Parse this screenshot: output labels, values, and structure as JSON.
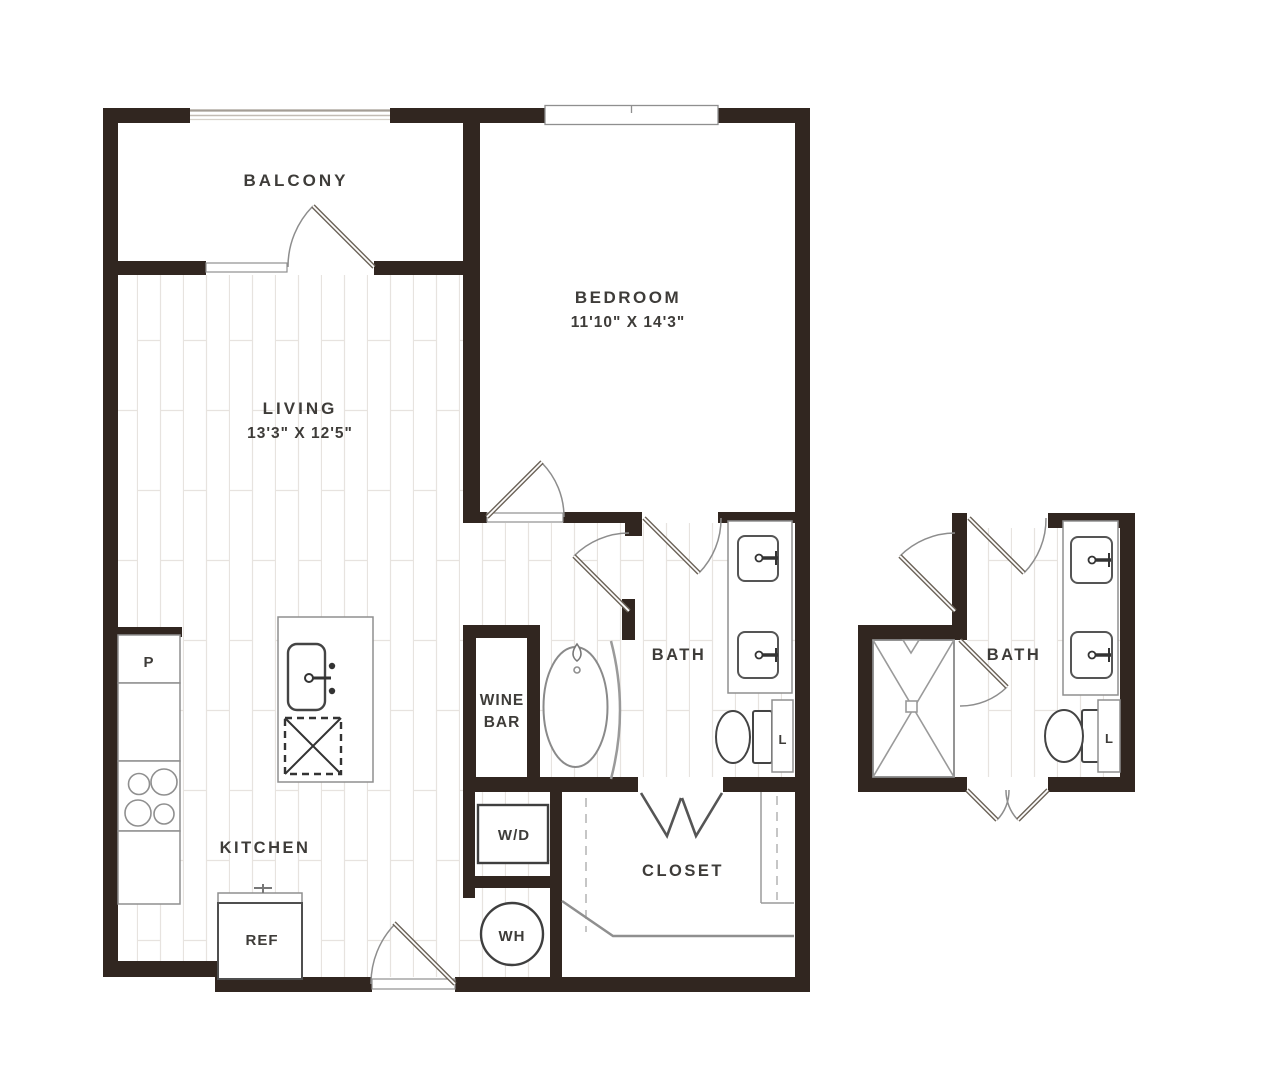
{
  "colors": {
    "wall": "#312620",
    "line": "#8f8f8f",
    "text": "#3e3c39",
    "plank": "#e7e3df",
    "fixdark": "#3f3f3f"
  },
  "rooms": {
    "balcony": {
      "label": "BALCONY"
    },
    "bedroom": {
      "label": "BEDROOM",
      "dims": "11'10\" X 14'3\""
    },
    "living": {
      "label": "LIVING",
      "dims": "13'3\" X 12'5\""
    },
    "kitchen": {
      "label": "KITCHEN"
    },
    "wine_bar": {
      "label_line1": "WINE",
      "label_line2": "BAR"
    },
    "bath": {
      "label": "BATH"
    },
    "closet": {
      "label": "CLOSET"
    }
  },
  "fixtures": {
    "washer_dryer": "W/D",
    "water_heater": "WH",
    "refrigerator": "REF",
    "pantry": "P",
    "linen": "L"
  },
  "detail": {
    "bath_label": "BATH",
    "linen_label": "L"
  }
}
